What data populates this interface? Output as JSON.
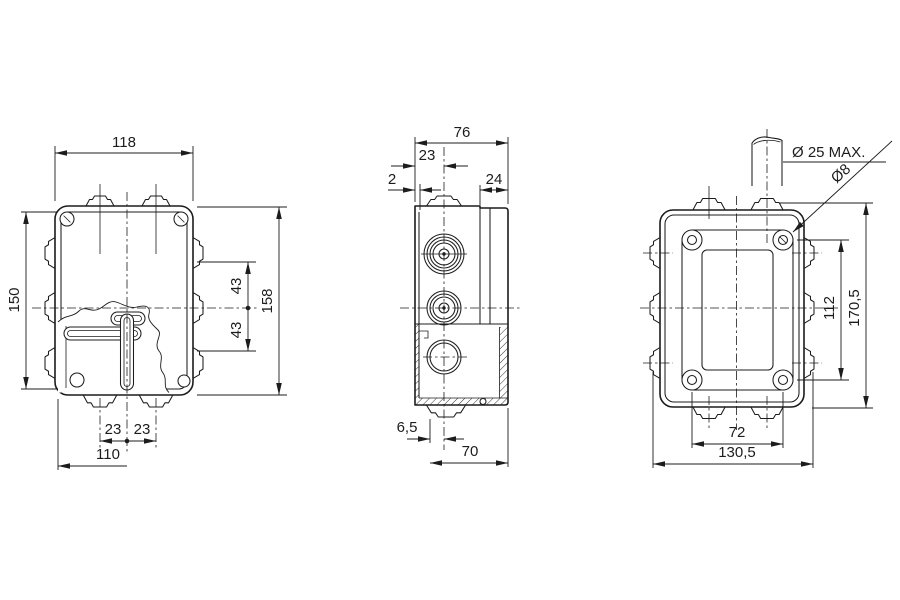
{
  "drawing": {
    "background": "#ffffff",
    "line_color": "#1c1c1c",
    "views": {
      "front": {
        "dims": {
          "width": "118",
          "height": "158",
          "inner_height": "150",
          "upper_hole_offset": "43",
          "lower_hole_offset": "43",
          "knockout_left_offset": "23",
          "knockout_right_offset": "23",
          "base_width": "110"
        }
      },
      "side": {
        "dims": {
          "depth": "76",
          "knockout_center_offset": "23",
          "wall_thickness": "2",
          "lid_depth": "24",
          "foot_offset": "6,5",
          "body_depth": "70"
        }
      },
      "back": {
        "dims": {
          "cable_entry_max": "Ø 25 MAX.",
          "fixing_hole_diameter": "Ø8",
          "hole_spacing_vertical": "112",
          "overall_height": "170,5",
          "hole_spacing_horizontal": "72",
          "overall_width": "130,5"
        }
      }
    }
  }
}
